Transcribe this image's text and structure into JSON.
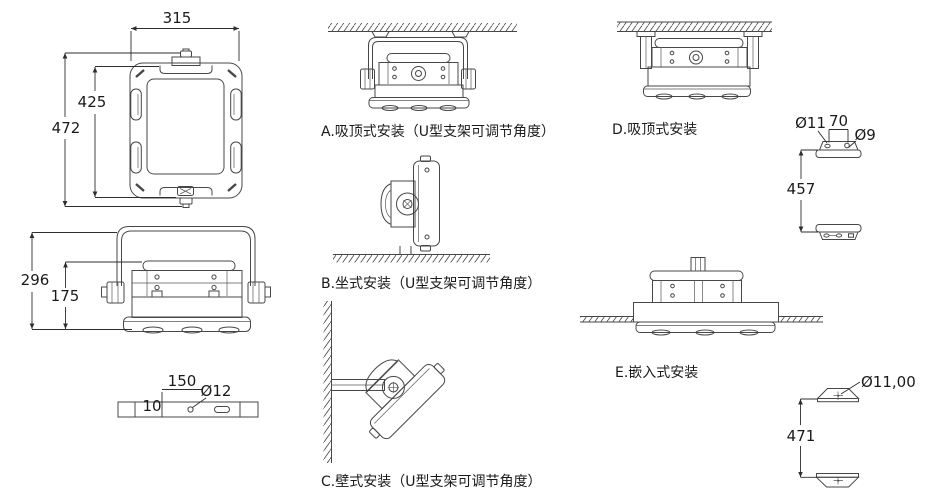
{
  "colors": {
    "line": "#474747",
    "dim_line": "#2e2e2e",
    "text": "#1a1a1a",
    "background": "#ffffff"
  },
  "front_view": {
    "dim_width": "315",
    "dim_inner_height": "425",
    "dim_outer_height": "472"
  },
  "side_view": {
    "dim_total_height": "296",
    "dim_body_height": "175"
  },
  "bottom_view": {
    "dim_hole_spacing": "150",
    "dim_edge_offset": "10",
    "dim_hole_diameter": "Ø12"
  },
  "captions": {
    "a": "A.吸顶式安装（U型支架可调节角度）",
    "b": "B.坐式安装（U型支架可调节角度）",
    "c": "C.壁式安装（U型支架可调节角度）",
    "d": "D.吸顶式安装",
    "e": "E.嵌入式安装"
  },
  "bracket_detail_top": {
    "dim_hole_left": "Ø11",
    "dim_hole_spacing": "70",
    "dim_hole_right": "Ø9",
    "dim_distance": "457"
  },
  "bracket_detail_bottom": {
    "dim_hole": "Ø11,00",
    "dim_distance": "471"
  }
}
